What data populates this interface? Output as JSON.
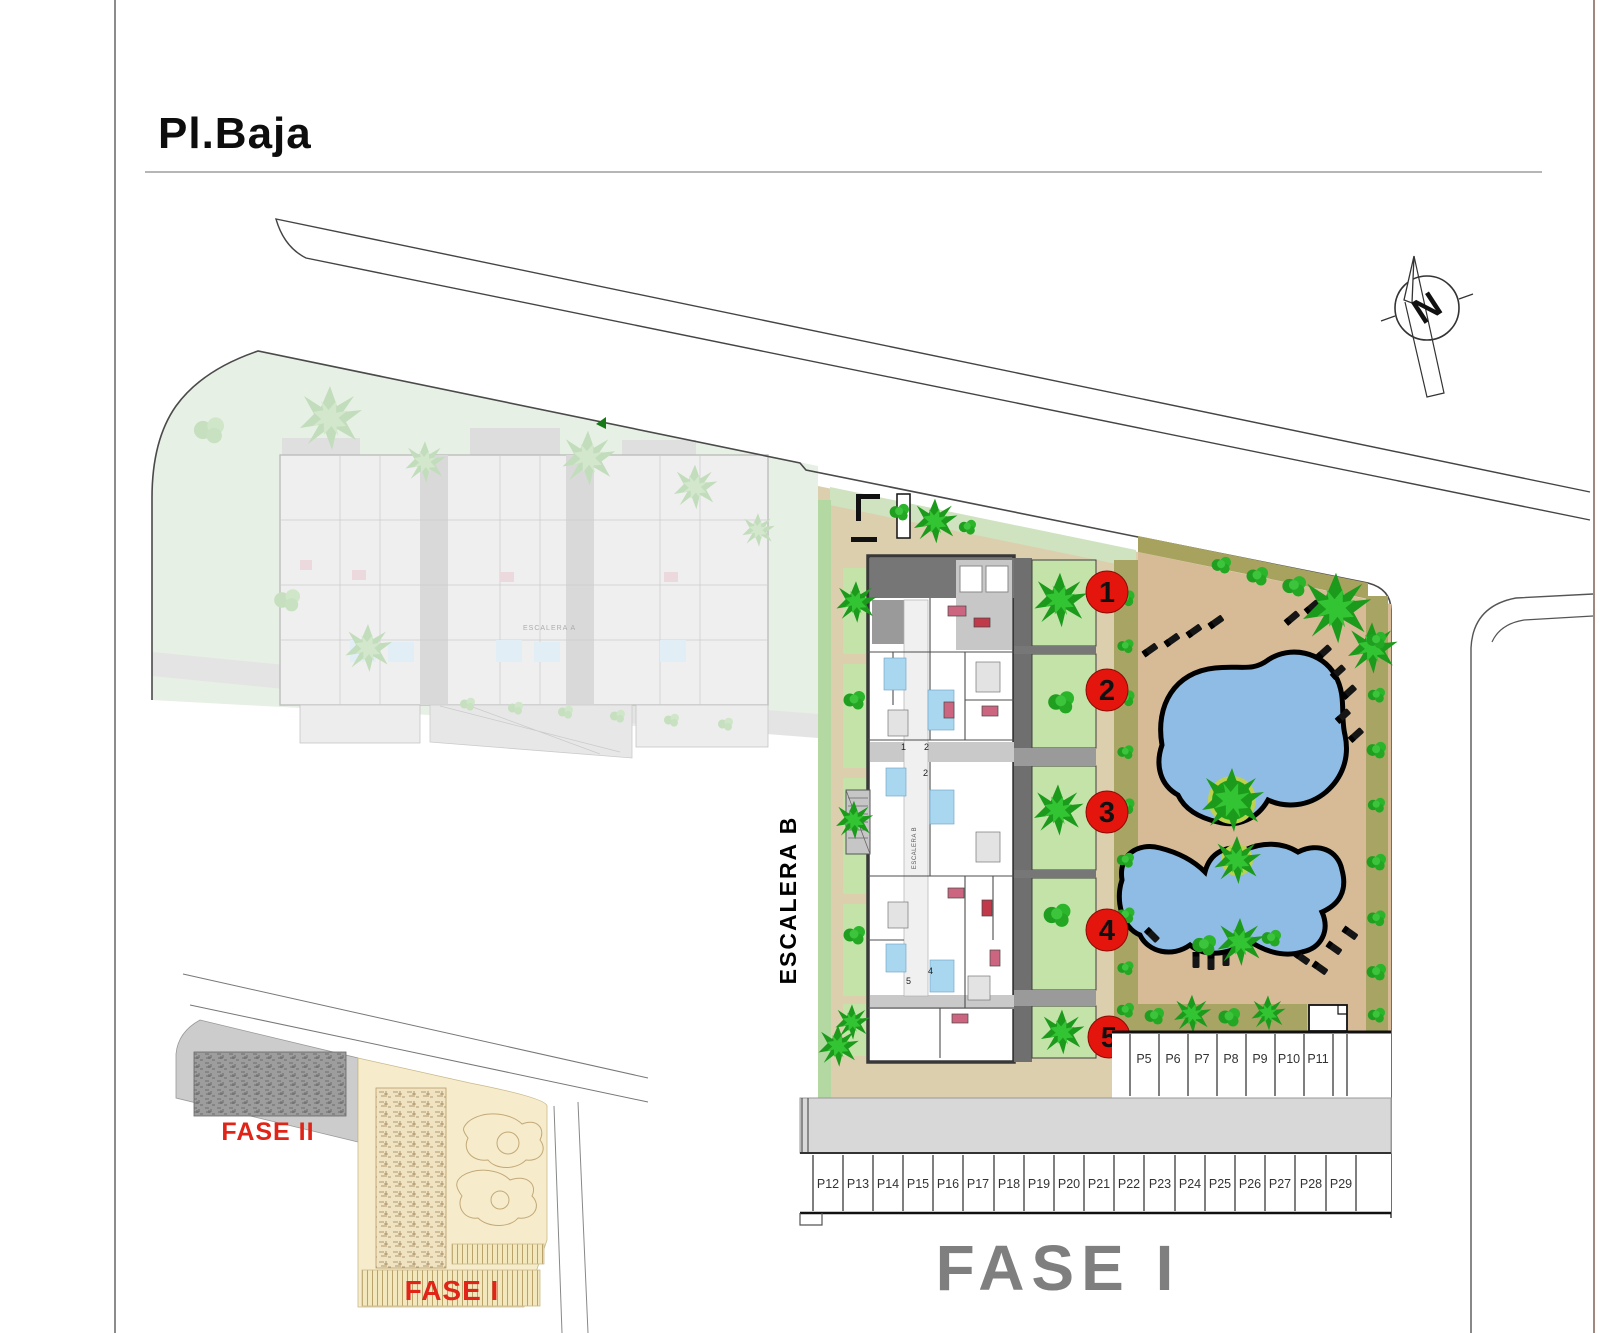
{
  "page": {
    "title": "Pl.Baja"
  },
  "compass": {
    "label": "N"
  },
  "phase1": {
    "big_label": "FASE I",
    "stair_label": "ESCALERA B",
    "unit_markers": [
      "1",
      "2",
      "3",
      "4",
      "5"
    ],
    "small_digits": [
      "1",
      "2",
      "2",
      "4",
      "5"
    ],
    "parking_top": [
      "P5",
      "P6",
      "P7",
      "P8",
      "P9",
      "P10",
      "P11"
    ],
    "parking_bottom": [
      "P12",
      "P13",
      "P14",
      "P15",
      "P16",
      "P17",
      "P18",
      "P19",
      "P20",
      "P21",
      "P22",
      "P23",
      "P24",
      "P25",
      "P26",
      "P27",
      "P28",
      "P29"
    ]
  },
  "phase2": {
    "stair_label": "ESCALERA A"
  },
  "inset": {
    "fase2_label": "FASE II",
    "fase1_label": "FASE I"
  },
  "colors": {
    "marker_red": "#e3150d",
    "phase_text_red": "#e02418",
    "phase_text_grey": "#7f7f7f",
    "pool_blue": "#8fbce4",
    "deck_tan": "#d7bb97",
    "walkway_tan": "#dccfae",
    "garden_green": "#c4e3a9",
    "band_green": "#cfe3c0",
    "tree_green": "#1c9a1c",
    "hedge_olive": "#a8a464",
    "road_grey": "#d8d8d8",
    "inset_cream": "#f6eccb"
  }
}
